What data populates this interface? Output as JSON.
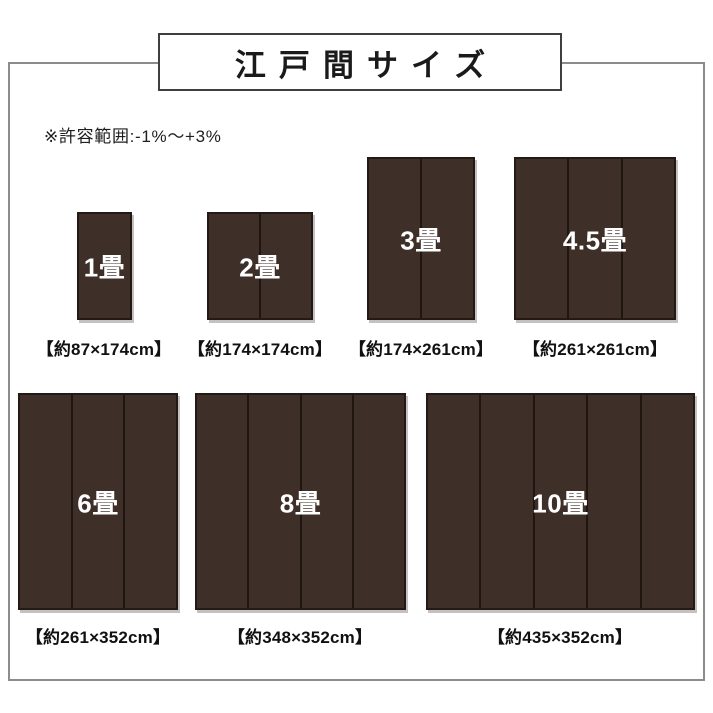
{
  "title": "江戸間サイズ",
  "note": "※許容範囲:-1%〜+3%",
  "colors": {
    "mat": "#3e2f28",
    "mat_divider": "#1f1611",
    "mat_border": "#241a13",
    "mat_label": "#ffffff",
    "frame_border": "#8c8c8c",
    "title_border": "#3f3f3f"
  },
  "mats": [
    {
      "label": "1畳",
      "size": "【約87×174cm】",
      "panels": 1
    },
    {
      "label": "2畳",
      "size": "【約174×174cm】",
      "panels": 2
    },
    {
      "label": "3畳",
      "size": "【約174×261cm】",
      "panels": 2
    },
    {
      "label": "4.5畳",
      "size": "【約261×261cm】",
      "panels": 3
    },
    {
      "label": "6畳",
      "size": "【約261×352cm】",
      "panels": 3
    },
    {
      "label": "8畳",
      "size": "【約348×352cm】",
      "panels": 4
    },
    {
      "label": "10畳",
      "size": "【約435×352cm】",
      "panels": 5
    }
  ]
}
